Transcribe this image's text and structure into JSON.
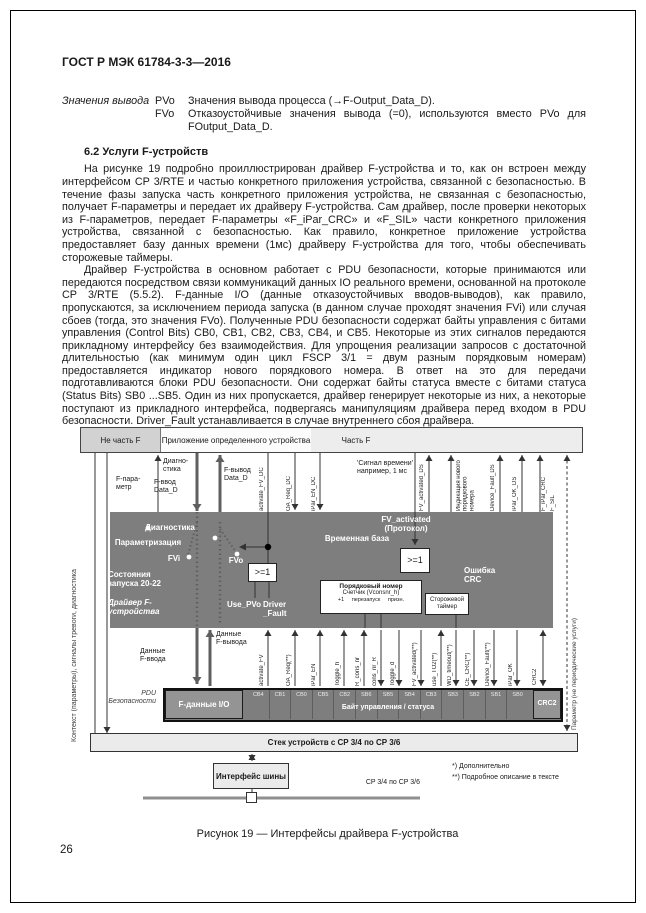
{
  "page": {
    "header": "ГОСТ Р МЭК 61784-3-3—2016",
    "page_number": "26"
  },
  "definitions": {
    "term": "Значения вывода",
    "items": [
      {
        "abbr": "PVo",
        "text": "Значения вывода процесса (→F-Output_Data_D)."
      },
      {
        "abbr": "FVo",
        "text": "Отказоустойчивые значения вывода (=0), используются вместо PVo для FOutput_Data_D."
      }
    ]
  },
  "section": {
    "heading": "6.2  Услуги F-устройств",
    "paragraphs": [
      "На рисунке 19 подробно проиллюстрирован драйвер F-устройства и то, как он встроен между интерфейсом CP 3/RTE и частью конкретного приложения устройства, связанной с безопасностью. В течение фазы запуска часть конкретного приложения устройства, не связанная с безопасностью, получает F-параметры и передает их драйверу F-устройства. Сам драйвер, после проверки некоторых из F-параметров, передает F-параметры «F_iPar_CRC» и «F_SIL» части конкретного приложения устройства, связанной с безопасностью. Как правило, конкретное приложение устройства предоставляет базу данных времени (1мс) драйверу F-устройства для того, чтобы обеспечивать сторожевые таймеры.",
      "Драйвер F-устройства в основном работает с PDU безопасности, которые принимаются или передаются посредством связи коммуникаций данных IO реального времени, основанной на протоколе CP 3/RTE (5.5.2). F-данные I/O (данные отказоустойчивых вводов-выводов), как правило, пропускаются, за исключением периода запуска (в данном случае проходят значения FVi) или случая сбоев (тогда, это значения FVo). Полученные PDU безопасности содержат байты управления с битами управления (Control Bits) CB0, CB1, CB2, CB3, CB4, и CB5. Некоторые из этих сигналов передаются прикладному интерфейсу без взаимодействия. Для упрощения реализации запросов с достаточной длительностью (как минимум один цикл FSCP 3/1 = двум разным порядковым номерам) предоставляется индикатор нового порядкового номера. В ответ на это для передачи подготавливаются блоки PDU безопасности. Они содержат байты статуса вместе с битами статуса (Status Bits) SB0 ...SB5. Один из них пропускается, драйвер генерирует некоторые из них, а некоторые поступают из прикладного интерфейса, подвергаясь манипуляциям драйвера перед входом в PDU безопасности. Driver_Fault устанавливается в случае внутреннего сбоя драйвера."
    ]
  },
  "figure": {
    "caption": "Рисунок 19 — Интерфейсы драйвера F-устройства",
    "zones": {
      "left": "Не часть F",
      "middle": "Приложение определенного устройства",
      "right": "Часть F"
    },
    "left_rotated": "Контекст (параметры), сигналы тревоги, диагностика",
    "right_rotated": "Параметр (не периодические услуги)",
    "top_labels": {
      "diag": "Диагно-\nстика",
      "f_param": "F-пара-\nметр",
      "f_input": "F-ввод\nData_D",
      "f_output": "F-вывод\nData_D",
      "activate_fv_dc": "activate_FV_DC",
      "oa_req_dc": "OA_Req_DC",
      "ipar_en_dc": "iPar_EN_DC",
      "time_signal": "'Сигнал времени'\nнапример, 1 мс",
      "fv_activated_ds": "FV_activated_DS",
      "new_seq": "Индикация нового\nпорядкового\nномера",
      "device_fault_ds": "Device_Fault_DS",
      "ipar_ok_ds": "iPar_OK_DS",
      "f_ipar_crc": "F_iPar_CRC",
      "f_sil": "F_SIL"
    },
    "driver": {
      "diagnostics": "Диагностика",
      "parametrization": "Параметризация",
      "fvi": "FVi",
      "startup": "Состояния\nзапуска 20-22",
      "name": "Драйвер F-\nустройства",
      "fvo": "FVo",
      "use_pvo": "Use_PVo",
      "driver_fault": "Driver\n_Fault",
      "time_base": "Временная база",
      "fv_activated": "FV_activated\n(Протокол)",
      "crc_error": "Ошибка\nCRC",
      "or1": ">=1",
      "or2": ">=1",
      "seq_box_title": "Порядковый номер",
      "seq_box_sub": "Счетчик (Vconsnr_h)",
      "seq_box_row": "+1     перезапуск     призн.",
      "watchdog": "Сторожевой\nтаймер"
    },
    "mid_labels": {
      "f_output_data": "Данные\nF-вывода",
      "f_input_data": "Данные\nF-ввода"
    },
    "gap_signals": [
      "activate_FV",
      "OA_Req(**)",
      "iPar_EN",
      "Toggle_h",
      "R_cons_nr",
      "cons_nr_R",
      "Toggle_d",
      "FV_activated(**)",
      "use_TO2(**)",
      "WD_timeout(**)",
      "CE_CRC(**)",
      "Device_Fault(**)",
      "iPar_OK",
      "CRC2"
    ],
    "pdu": {
      "label": "PDU\nБезопасности",
      "f_data": "F-данные I/O",
      "cells": [
        "CB4",
        "CB1",
        "CB0",
        "CB5",
        "CB2",
        "SB6",
        "SB5",
        "SB4",
        "CB3",
        "SB3",
        "SB2",
        "SB1",
        "SB0"
      ],
      "cells_caption": "Байт управления / статуса",
      "crc2": "CRC2"
    },
    "stack_bar": "Стек устройств с CP 3/4 по CP 3/6",
    "bus_box": "Интерфейс шины",
    "bus_label": "CP 3/4 по CP 3/6",
    "footnotes": [
      "*) Дополнительно",
      "**) Подробное описание в тексте"
    ]
  }
}
